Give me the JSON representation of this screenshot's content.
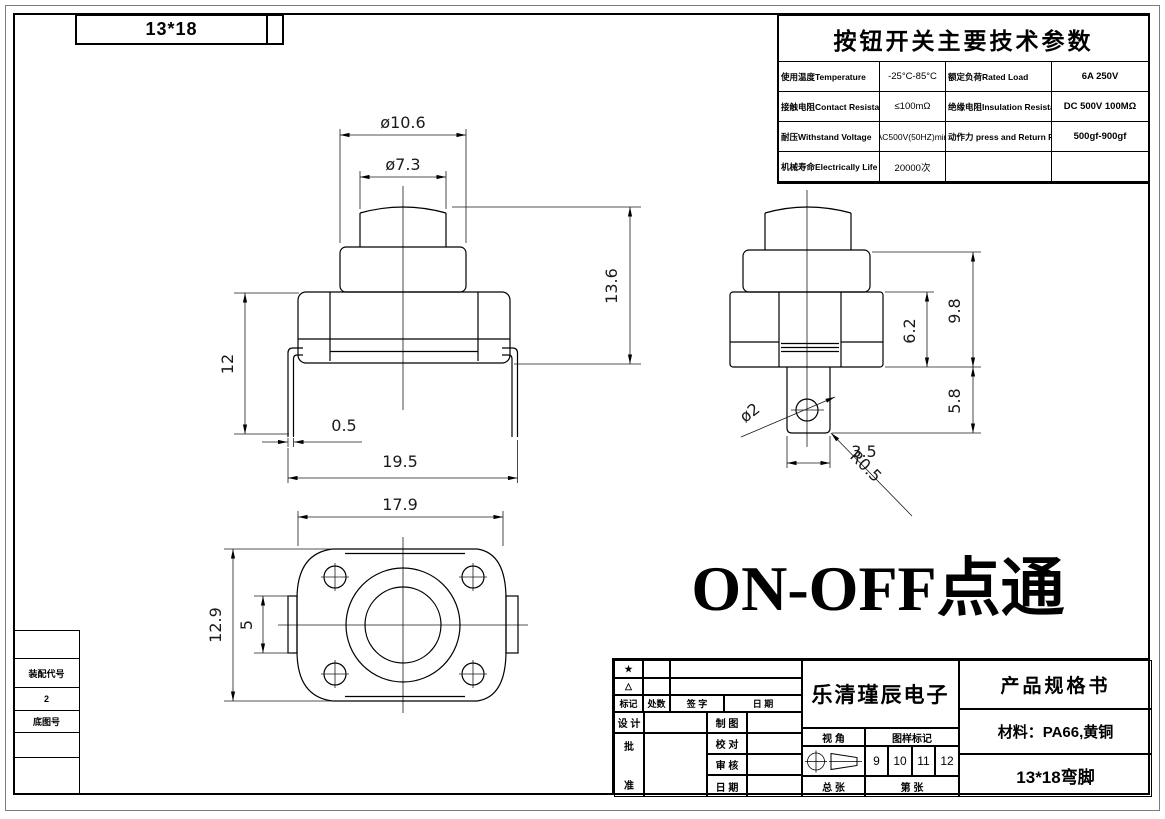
{
  "page": {
    "code_box": "13*18",
    "note": "ON-OFF点通"
  },
  "left_strip": {
    "assembly_label": "装配代号",
    "assembly_value": "2",
    "base_label": "底图号"
  },
  "tech_table": {
    "title": "按钮开关主要技术参数",
    "rows": [
      {
        "l1": "使用温度Temperature",
        "v1": "-25°C-85°C",
        "l2": "额定负荷Rated Load",
        "v2": "6A 250V"
      },
      {
        "l1": "接触电阻Contact Resistance",
        "v1": "≤100mΩ",
        "l2": "绝缘电阻Insulation Resistance",
        "v2": "DC 500V  100MΩ"
      },
      {
        "l1": "耐压Withstand Voltage",
        "v1": "AC500V(50HZ)min",
        "l2": "动作力 press and Return Force",
        "v2": "500gf-900gf"
      },
      {
        "l1": "机械寿命Electrically Life",
        "v1": "20000次",
        "l2": "",
        "v2": ""
      }
    ]
  },
  "dims": {
    "front": {
      "top_dia": "ø10.6",
      "btn_dia": "ø7.3",
      "h_total": "13.6",
      "h_body": "12",
      "leg_t": "0.5",
      "w_pins": "19.5"
    },
    "side": {
      "h_upper": "6.2",
      "h_base": "9.8",
      "h_pin": "5.8",
      "hole": "ø2",
      "pin_w": "3.5",
      "corner_r": "R0.5"
    },
    "bottom": {
      "w": "17.9",
      "h": "12.9",
      "tab": "5"
    }
  },
  "title_block": {
    "star": "★",
    "triangle": "△",
    "h_mark": "标记",
    "h_count": "处数",
    "h_sign": "签  字",
    "h_date": "日  期",
    "design": "设 计",
    "draft": "制 图",
    "check": "校 对",
    "audit": "审 核",
    "date": "日 期",
    "approve_top": "批",
    "approve_bottom": "准",
    "company": "乐清瑾辰电子",
    "view_label": "视  角",
    "mark_label": "图样标记",
    "nums": [
      "9",
      "10",
      "11",
      "12"
    ],
    "total_sheets": "总    张",
    "sheet_no": "第        张",
    "doc_type": "产品规格书",
    "material": "材料：PA66,黄铜",
    "product": "13*18弯脚"
  }
}
